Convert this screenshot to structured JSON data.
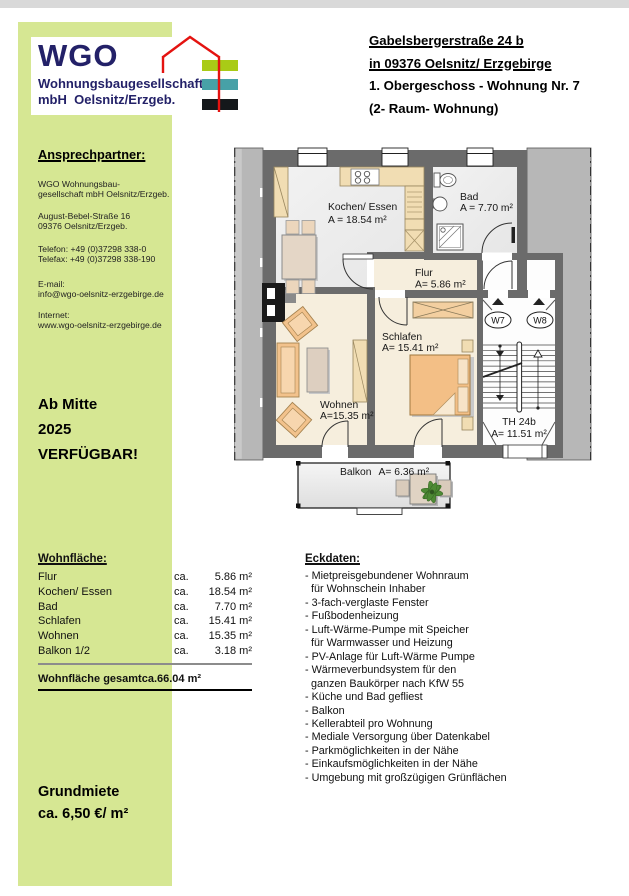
{
  "logo": {
    "acronym": "WGO",
    "line1": "Wohnungsbaugesellschaft",
    "line2": "mbH  Oelsnitz/Erzgeb.",
    "navy": "#232168",
    "bar_green": "#a9cb16",
    "bar_teal": "#47a1a7",
    "bar_black": "#14181b",
    "roof_red": "#e41310",
    "panel_green": "#d6e793"
  },
  "header": {
    "line1": "Gabelsbergerstraße 24 b",
    "line2": "in 09376 Oelsnitz/ Erzgebirge",
    "line3": "1. Obergeschoss - Wohnung Nr. 7",
    "line4": "(2- Raum- Wohnung)"
  },
  "contact": {
    "heading": "Ansprechpartner:",
    "company": [
      "WGO Wohnungsbau-",
      "gesellschaft mbH Oelsnitz/Erzgeb."
    ],
    "address": [
      "August-Bebel-Straße 16",
      "09376 Oelsnitz/Erzgeb."
    ],
    "phone": [
      "Telefon: +49 (0)37298 338-0",
      "Telefax: +49 (0)37298 338-190"
    ],
    "email": [
      "E-mail:",
      "info@wgo-oelsnitz-erzgebirge.de"
    ],
    "web": [
      "Internet:",
      "www.wgo-oelsnitz-erzgebirge.de"
    ]
  },
  "availability": {
    "lines": [
      "Ab Mitte",
      "2025",
      "VERFÜGBAR!"
    ]
  },
  "plan": {
    "kochen": {
      "name": "Kochen/ Essen",
      "area": "A = 18.54 m²"
    },
    "bad": {
      "name": "Bad",
      "area": "A = 7.70 m²"
    },
    "flur": {
      "name": "Flur",
      "area": "A= 5.86 m²"
    },
    "schlafen": {
      "name": "Schlafen",
      "area": "A= 15.41 m²"
    },
    "wohnen": {
      "name": "Wohnen",
      "area": "A=15.35 m²"
    },
    "treppenhaus": {
      "name": "TH 24b",
      "area": "A= 11.51 m²"
    },
    "balkon": {
      "name": "Balkon",
      "area": "A= 6.36 m²"
    },
    "w7": "W7",
    "w8": "W8"
  },
  "wohnflaeche": {
    "heading": "Wohnfläche:",
    "rows": [
      {
        "label": "Flur",
        "ca": "ca.",
        "value": "5.86 m²"
      },
      {
        "label": "Kochen/ Essen",
        "ca": "ca.",
        "value": "18.54 m²"
      },
      {
        "label": "Bad",
        "ca": "ca.",
        "value": "7.70 m²"
      },
      {
        "label": "Schlafen",
        "ca": "ca.",
        "value": "15.41 m²"
      },
      {
        "label": "Wohnen",
        "ca": "ca.",
        "value": "15.35 m²"
      },
      {
        "label": "Balkon 1/2",
        "ca": "ca.",
        "value": "3.18 m²"
      }
    ],
    "total_label": "Wohnfläche gesamt",
    "total_ca": "ca.",
    "total_value": "66.04 m²"
  },
  "eckdaten": {
    "heading": "Eckdaten:",
    "items": [
      "- Mietpreisgebundener Wohnraum",
      "  für Wohnschein Inhaber",
      "- 3-fach-verglaste Fenster",
      "- Fußbodenheizung",
      "- Luft-Wärme-Pumpe mit Speicher",
      "  für Warmwasser und Heizung",
      "- PV-Anlage für Luft-Wärme Pumpe",
      "- Wärmeverbundsystem für den",
      "  ganzen Baukörper nach KfW 55",
      "- Küche und Bad gefliest",
      "- Balkon",
      "- Kellerabteil pro Wohnung",
      "- Mediale Versorgung über Datenkabel",
      "- Parkmöglichkeiten in der Nähe",
      "- Einkaufsmöglichkeiten in der Nähe",
      "- Umgebung mit großzügigen Grünflächen"
    ]
  },
  "rent": {
    "lines": [
      "Grundmiete",
      "ca. 6,50 €/ m²"
    ]
  }
}
